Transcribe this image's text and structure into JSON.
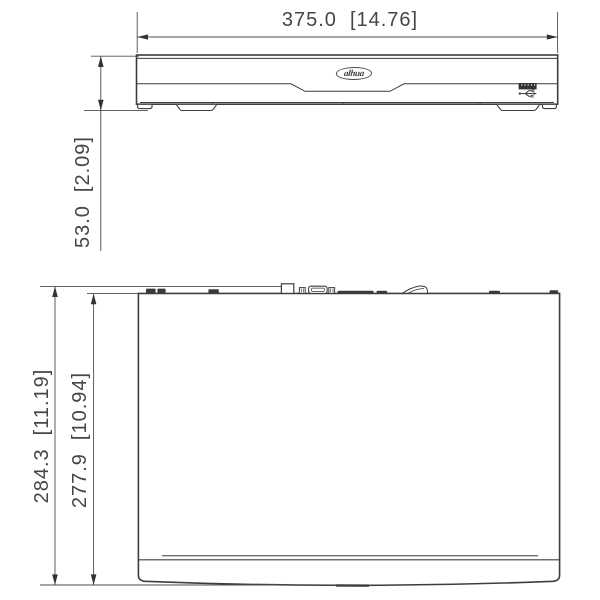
{
  "front_view": {
    "logo_text": "alhua",
    "width_dim": {
      "mm": "375.0",
      "inch": "[14.76]"
    },
    "height_dim": {
      "mm": "53.0",
      "inch": "[2.09]"
    }
  },
  "top_view": {
    "overall_depth_dim": {
      "mm": "284.3",
      "inch": "[11.19]"
    },
    "body_depth_dim": {
      "mm": "277.9",
      "inch": "[10.94]"
    }
  },
  "colors": {
    "background": "#ffffff",
    "outline": "#3d3d3d",
    "dimension_line": "#4d4d4d",
    "dimension_text": "#464646",
    "connector_fill": "#3a3a3a",
    "usb_port_fill": "#333333"
  },
  "icons": {
    "usb": "usb-trident-icon",
    "logo": "dahua-logo-oval"
  }
}
